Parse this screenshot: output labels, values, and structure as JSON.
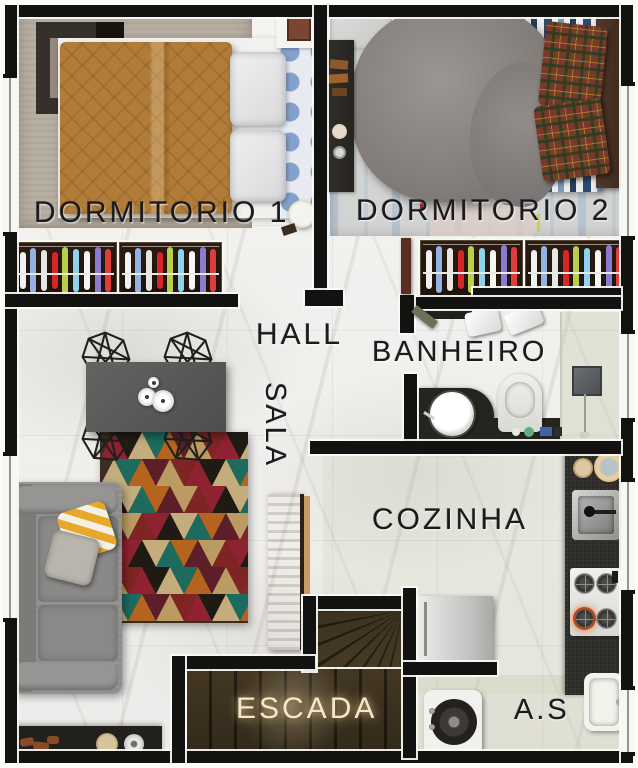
{
  "title": "Planta humanizada - pavimento",
  "rooms": {
    "dormitorio1": {
      "label": "DORMITORIO 1"
    },
    "dormitorio2": {
      "label": "DORMITORIO 2"
    },
    "hall": {
      "label": "HALL"
    },
    "sala": {
      "label": "SALA"
    },
    "banheiro": {
      "label": "BANHEIRO"
    },
    "cozinha": {
      "label": "COZINHA"
    },
    "escada": {
      "label": "ESCADA"
    },
    "area_servico": {
      "label": "A.S"
    }
  },
  "palette": {
    "wall": "#121210",
    "floor_marble": "#f2f1ee",
    "kitchen_tint": "#c3c6a5",
    "label_text": "#1b1b1e",
    "escada_text": "#f4e7cd",
    "bed1_duvet": "#b07c38",
    "bed2_blanket": "#85807c",
    "sofa": "#8e8d8b",
    "counter": "#2d2c28",
    "wood_console": "#b5834e",
    "stair_carpet": "#473a25"
  },
  "closets": {
    "clothes_colors": [
      "#f2f2f2",
      "#93b4e3",
      "#e8e6e2",
      "#d7262a",
      "#b9cf4a",
      "#8ed2ee",
      "#f6f6f4",
      "#8a7bd1",
      "#e03c3c",
      "#dcdcd8"
    ],
    "bars_per_section": 9
  },
  "rug": {
    "palette": [
      "#8e2230",
      "#1d6a5e",
      "#bb9b62",
      "#201a14",
      "#b4641f",
      "#7e2423",
      "#c4ad7c",
      "#5c1f29"
    ],
    "rows": 7,
    "cols": 11
  }
}
